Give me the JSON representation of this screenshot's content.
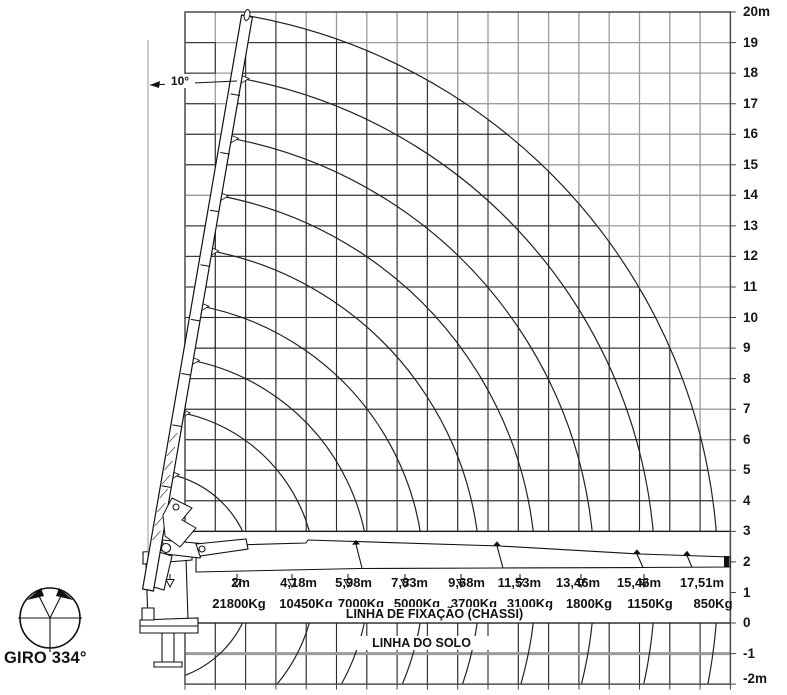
{
  "axis": {
    "labels": [
      "20m",
      "19",
      "18",
      "17",
      "16",
      "15",
      "14",
      "13",
      "12",
      "11",
      "10",
      "9",
      "8",
      "7",
      "6",
      "5",
      "4",
      "3",
      "2",
      "1",
      "0",
      "-1",
      "-2m"
    ]
  },
  "loads": [
    {
      "radius": "2m",
      "capacity": "21800Kg"
    },
    {
      "radius": "4,18m",
      "capacity": "10450Kg"
    },
    {
      "radius": "5,98m",
      "capacity": "7000Kg"
    },
    {
      "radius": "7,83m",
      "capacity": "5000Kg"
    },
    {
      "radius": "9,68m",
      "capacity": "3700Kg"
    },
    {
      "radius": "11,53m",
      "capacity": "3100Kg"
    },
    {
      "radius": "13,46m",
      "capacity": "1800Kg"
    },
    {
      "radius": "15,46m",
      "capacity": "1150Kg"
    },
    {
      "radius": "17,51m",
      "capacity": "850Kg"
    }
  ],
  "labels": {
    "chassis_line": "LINHA DE FIXAÇÃO (CHASSI)",
    "ground_line": "LINHA DO SOLO",
    "rotation": "GIRO 334°",
    "boom_angle": "10°"
  },
  "chart_data": {
    "type": "table",
    "title": "Crane load capacity diagram",
    "radii_m": [
      2,
      4.18,
      5.98,
      7.83,
      9.68,
      11.53,
      13.46,
      15.46,
      17.51
    ],
    "capacities_kg": [
      21800,
      10450,
      7000,
      5000,
      3700,
      3100,
      1800,
      1150,
      850
    ],
    "height_axis_m": {
      "min": -2,
      "max": 20,
      "unit": "m",
      "grid_step_m": 1
    },
    "slew_range_deg": 334,
    "boom_angle_from_vertical_deg": 10
  },
  "colors": {
    "background": "#ffffff",
    "grid_gray": "#9b9b9b",
    "grid_black": "#2e2e2e",
    "line_black": "#1a1a1a"
  }
}
